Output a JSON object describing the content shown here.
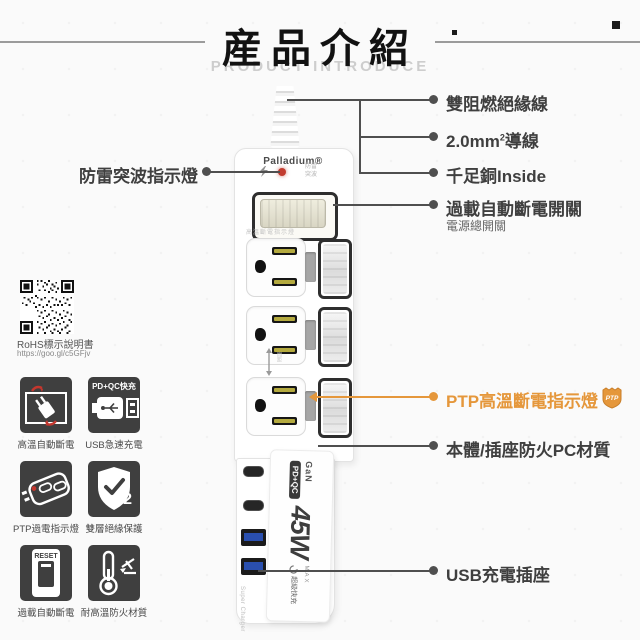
{
  "header": {
    "title": "産品介紹",
    "subtitle": "PRODUCT INTRODUCE"
  },
  "product": {
    "brand": "Palladium®",
    "led_note_top": "防雷",
    "led_note_bottom": "突波",
    "outlet_note": "高溫斷電指示燈",
    "spacing_note": "間距",
    "port_label_usbc": "PD",
    "port_label_usba": "USB",
    "super_charger": "Super Charger",
    "sticker": {
      "gan": "GaN",
      "pdqc": "PD+QC",
      "watt": "45W",
      "max": "MAX",
      "fast": "超級快充"
    }
  },
  "callouts": {
    "surge_led": "防雷突波指示燈",
    "insulated_wire": "雙阻燃絕緣線",
    "wire_pre": "2.0mm",
    "wire_sup": "2",
    "wire_post": "導線",
    "copper": "千足銅Inside",
    "main_switch": "過載自動斷電開關",
    "main_switch_sub": "電源總開關",
    "ptp": "PTP高溫斷電指示燈",
    "ptp_badge": "PTP",
    "pc_material": "本體/插座防火PC材質",
    "usb_socket": "USB充電插座"
  },
  "qr": {
    "caption": "RoHS標示說明書",
    "url": "https://goo.gl/c5GFjv"
  },
  "features": [
    {
      "label": "高溫自動斷電"
    },
    {
      "label": "USB急速充電",
      "tile_text": "PD+QC快充"
    },
    {
      "label": "PTP過電指示燈"
    },
    {
      "label": "雙層絕緣保護",
      "tile_text": "2"
    },
    {
      "label": "過載自動斷電",
      "tile_top": "RESET",
      "tile_bottom": "OFF"
    },
    {
      "label": "耐高溫防火材質"
    }
  ],
  "colors": {
    "accent_orange": "#E5973B",
    "led_red": "#C23B2E",
    "usb_blue": "#2A4FAE"
  }
}
